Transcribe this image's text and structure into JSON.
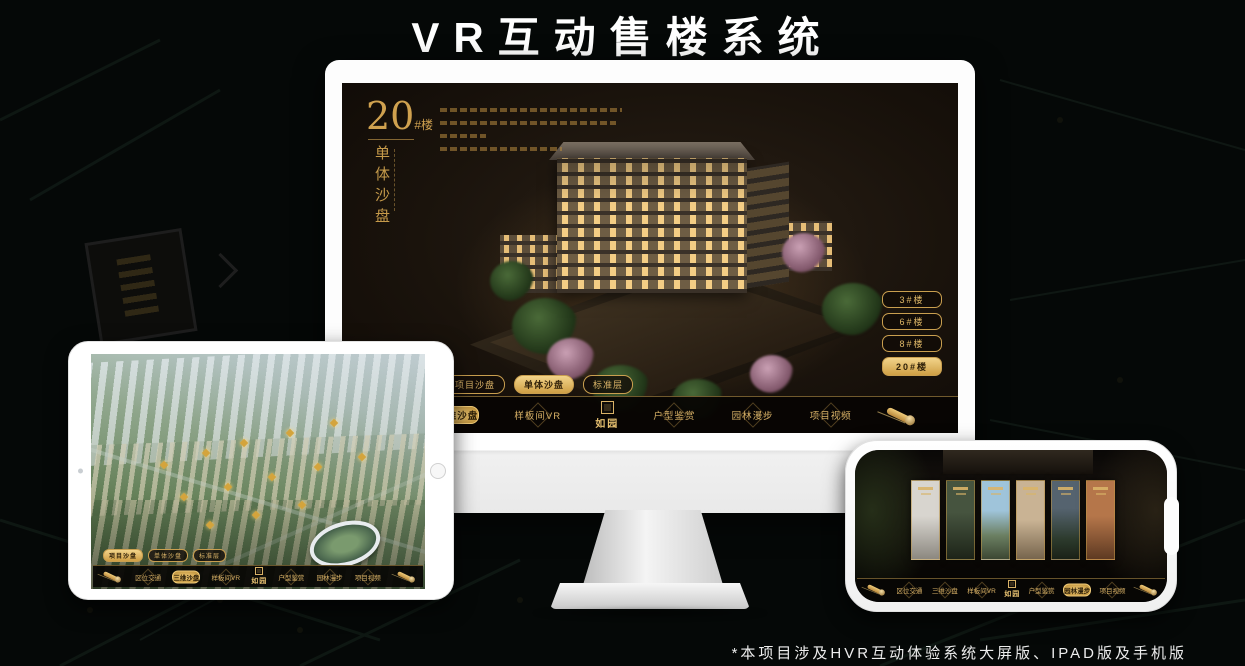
{
  "page": {
    "title": "VR互动售楼系统",
    "footnote": "*本项目涉及HVR互动体验系统大屏版、IPAD版及手机版"
  },
  "colors": {
    "accent_gold": "#c99f4f",
    "accent_gold_bright": "#f2d48a",
    "screen_background": "#1a130c",
    "nav_background": "#070503"
  },
  "monitor": {
    "headline": {
      "number": "20",
      "unit": "#楼",
      "vertical_title": "单体沙盘"
    },
    "floor_buttons": [
      {
        "label": "3#楼",
        "active": false
      },
      {
        "label": "6#楼",
        "active": false
      },
      {
        "label": "8#楼",
        "active": false
      },
      {
        "label": "20#楼",
        "active": true
      }
    ],
    "sub_tabs": [
      {
        "label": "项目沙盘",
        "active": false
      },
      {
        "label": "单体沙盘",
        "active": true
      },
      {
        "label": "标准层",
        "active": false
      }
    ],
    "nav": {
      "logo": "如园",
      "items": [
        {
          "label": "区位交通",
          "active": false
        },
        {
          "label": "三维沙盘",
          "active": true
        },
        {
          "label": "样板间VR",
          "active": false
        },
        {
          "label": "户型鉴赏",
          "active": false
        },
        {
          "label": "园林漫步",
          "active": false
        },
        {
          "label": "项目视频",
          "active": false
        }
      ]
    }
  },
  "tablet": {
    "sub_tabs": [
      {
        "label": "项目沙盘",
        "active": true
      },
      {
        "label": "单体沙盘",
        "active": false
      },
      {
        "label": "标准层",
        "active": false
      }
    ],
    "nav": {
      "logo": "如园",
      "items": [
        {
          "label": "区位交通",
          "active": false
        },
        {
          "label": "三维沙盘",
          "active": true
        },
        {
          "label": "样板间VR",
          "active": false
        },
        {
          "label": "户型鉴赏",
          "active": false
        },
        {
          "label": "园林漫步",
          "active": false
        },
        {
          "label": "项目视频",
          "active": false
        }
      ]
    }
  },
  "phone": {
    "nav": {
      "logo": "如园",
      "items": [
        {
          "label": "区位交通",
          "active": false
        },
        {
          "label": "三维沙盘",
          "active": false
        },
        {
          "label": "样板间VR",
          "active": false
        },
        {
          "label": "户型鉴赏",
          "active": false
        },
        {
          "label": "园林漫步",
          "active": true
        },
        {
          "label": "项目视频",
          "active": false
        }
      ]
    }
  }
}
